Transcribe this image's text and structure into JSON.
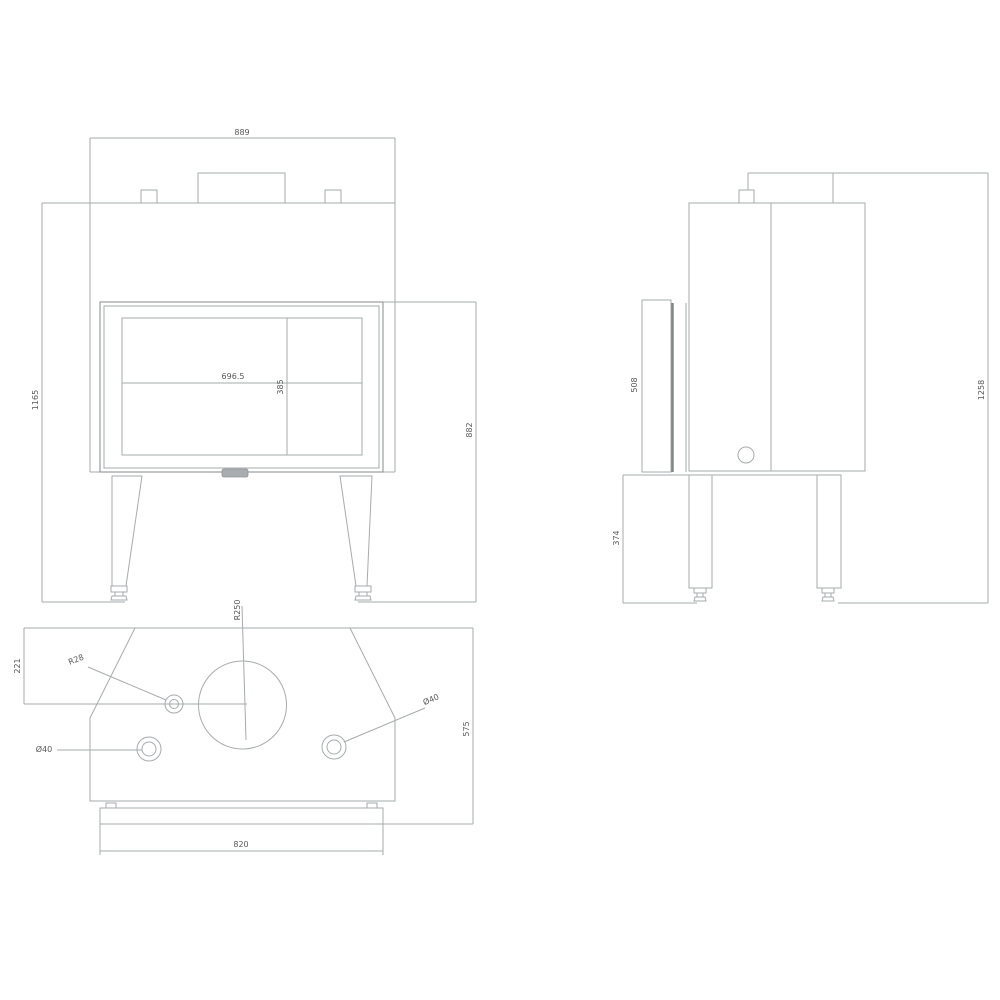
{
  "drawing": {
    "type": "technical-orthographic-drawing",
    "subject": "fireplace insert",
    "line_color": "#a6abae",
    "text_color": "#585858",
    "background": "#ffffff"
  },
  "views": {
    "front": {
      "name": "front view",
      "dims": {
        "top_width": "889",
        "overall_height": "1165",
        "firebox_height": "882",
        "glass_width": "696.5",
        "glass_height": "385"
      }
    },
    "side": {
      "name": "side view",
      "dims": {
        "door_panel_height": "508",
        "base_height": "374",
        "total_height": "1258"
      }
    },
    "plan": {
      "name": "top view",
      "dims": {
        "back_to_flue_center": "221",
        "flue_radius": "R250",
        "small_hole": "R28",
        "hole_left": "Ø40",
        "hole_right": "Ø40",
        "depth": "575",
        "base_width": "820"
      }
    }
  }
}
